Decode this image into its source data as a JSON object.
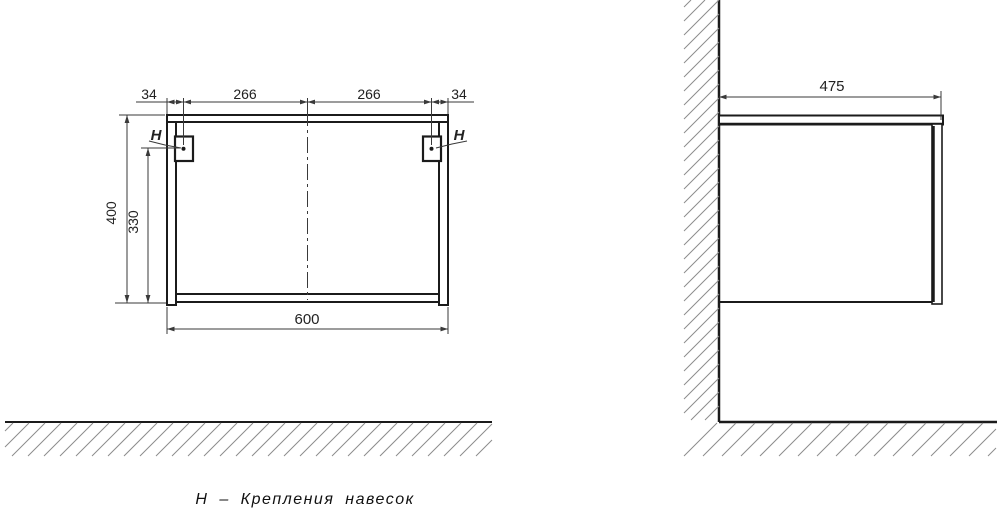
{
  "title_caption": "Н – Крепления навесок",
  "front_view": {
    "top_dims": [
      "34",
      "266",
      "266",
      "34"
    ],
    "height_total": "400",
    "mount_height": "330",
    "width_total": "600",
    "mount_label_left": "Н",
    "mount_label_right": "Н"
  },
  "side_view": {
    "depth_total": "475"
  },
  "colors": {
    "line": "#1b1b1b",
    "dimension": "#3a3a3a",
    "hatch": "#8c8c8c",
    "background": "#ffffff"
  }
}
